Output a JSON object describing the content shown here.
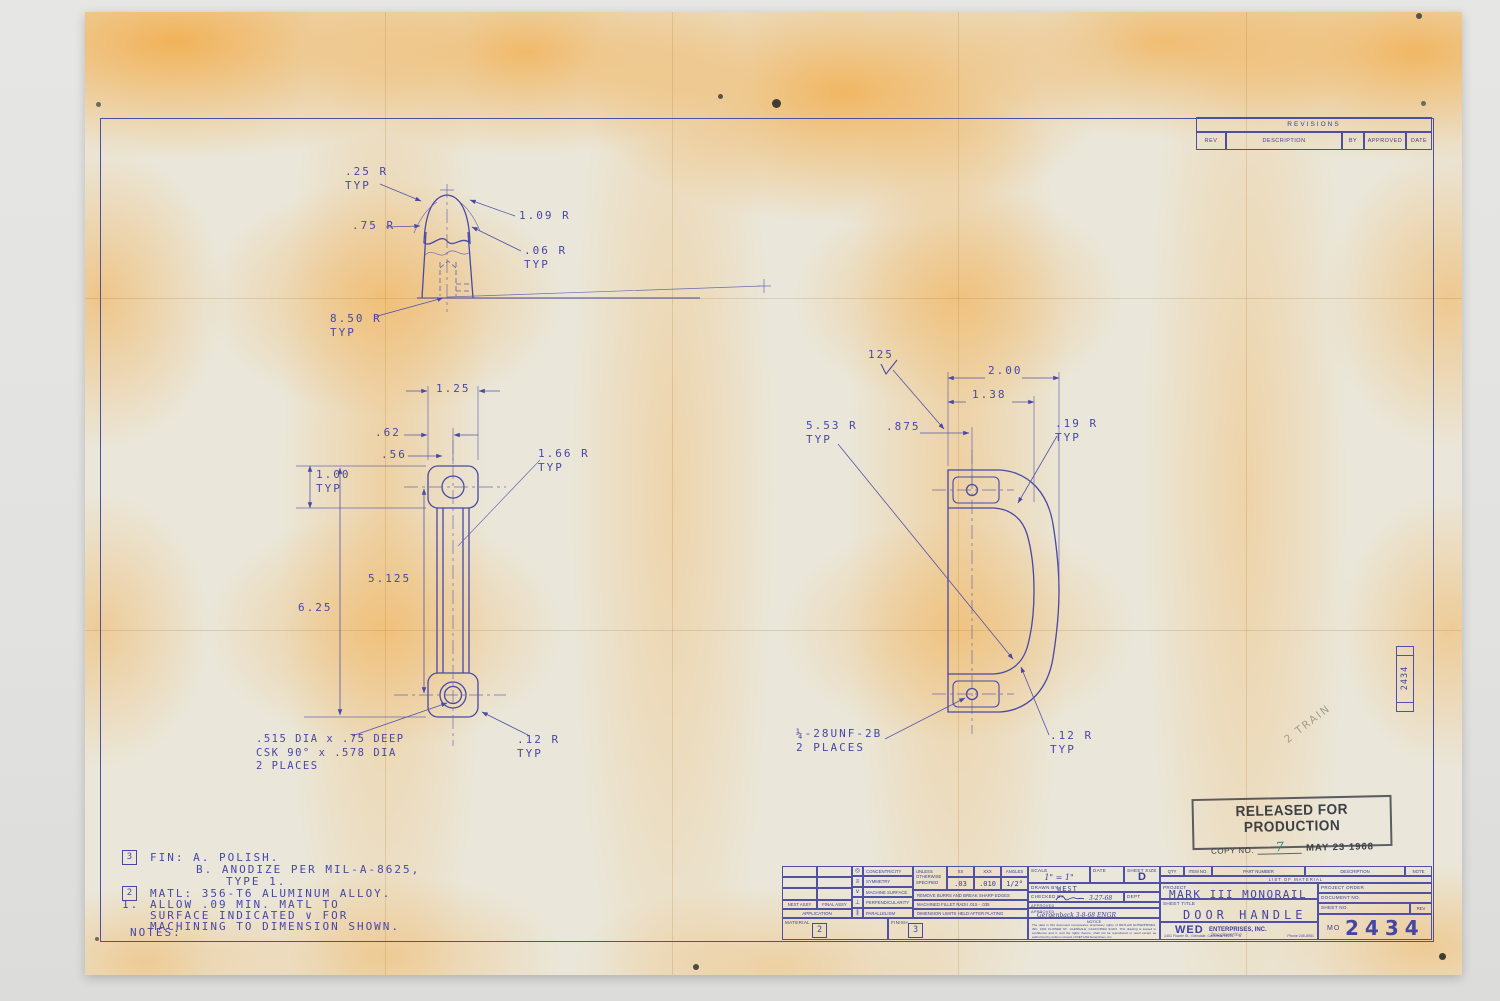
{
  "colors": {
    "ink": "#4848a6",
    "paper": "#eae7da",
    "aging": "#f2ae4e",
    "stamp": "#3e4046",
    "copy_teal": "#1e8e84",
    "pencil": "#a39d90"
  },
  "revisions": {
    "title": "REVISIONS",
    "col_rev": "REV",
    "col_description": "DESCRIPTION",
    "col_by": "BY",
    "col_approved": "APPROVED",
    "col_date": "DATE"
  },
  "section_view": {
    "r_25": ".25 R\nTYP",
    "r_75": ".75 R",
    "r_109": "1.09 R",
    "r_06": ".06 R\nTYP",
    "r_850": "8.50 R\nTYP"
  },
  "front_view": {
    "d_125": "1.25",
    "d_62": ".62",
    "d_56": ".56",
    "d_100": "1.00\nTYP",
    "r_166": "1.66 R\nTYP",
    "d_5125": "5.125",
    "d_625": "6.25",
    "hole_callout": ".515 DIA x .75 DEEP\nCSK 90° x .578 DIA\n2 PLACES",
    "r_12": ".12 R\nTYP"
  },
  "side_view": {
    "finish": "125",
    "d_200": "2.00",
    "d_138": "1.38",
    "d_875": ".875",
    "r_553": "5.53 R\nTYP",
    "r_19": ".19 R\nTYP",
    "thread": "¼-28UNF-2B\n2 PLACES",
    "r_12": ".12 R\nTYP"
  },
  "stamp": {
    "title": "RELEASED FOR PRODUCTION",
    "copy_label": "COPY NO.",
    "copy_value": "7",
    "date": "MAY 23 1968"
  },
  "pencil_note": "2 TRAIN",
  "edge_label": "2434",
  "notes": {
    "flag3": "3",
    "line1": "FIN: A. POLISH.",
    "line2": "B. ANODIZE PER MIL-A-8625,",
    "line3": "TYPE 1.",
    "flag2": "2",
    "line4": "MATL: 356-T6 ALUMINUM ALLOY.",
    "num1": "1.",
    "line5": "ALLOW .09 MIN. MATL TO",
    "line6": "SURFACE INDICATED ∨ FOR",
    "line7": "MACHINING TO DIMENSION SHOWN.",
    "header": "NOTES:"
  },
  "titleblock": {
    "next_assy": "NEXT ASSY",
    "final_assy": "FINAL ASSY",
    "application": "APPLICATION",
    "symbols": [
      {
        "sym": "◎",
        "label": "CONCENTRICITY"
      },
      {
        "sym": "≡",
        "label": "SYMMETRY"
      },
      {
        "sym": "∨",
        "label": "MACHINE SURFACE"
      },
      {
        "sym": "⊥",
        "label": "PERPENDICULARITY"
      },
      {
        "sym": "∥",
        "label": "PARALLELISM"
      }
    ],
    "tolerances": {
      "header": "UNLESS OTHERWISE SPECIFIED",
      "col1": "XX",
      "col2": "XXX",
      "col3": "ANGLES",
      "val1": ".03",
      "val2": ".010",
      "val3": "1/2°",
      "row1": "REMOVE BURRS AND BREAK SHARP EDGES",
      "row2": "MACHINED FILLET RADII .015 - .035",
      "row3": "DIMENSION LIMITS HELD AFTER PLATING"
    },
    "material_label": "MATERIAL",
    "material_flag": "2",
    "finish_label": "FINISH",
    "finish_flag": "3",
    "notice_title": "NOTICE",
    "notice_body": "The data in this document incorporates proprietary rights of RETLAW ENTERPRISES, INC.  1401 FLOWER ST., GLENDALE, CALIFORNIA 91201. This drawing is loaned in confidence and it, and the rights thereto, shall not be reproduced or used except as authorized by written consent of RETLAW Enterprises, Inc.",
    "scale_label": "SCALE",
    "scale_value": "1\" = 1\"",
    "date_label": "DATE",
    "sheet_size_label": "SHEET SIZE",
    "sheet_size_value": "D",
    "drawn_label": "DRAWN BY",
    "drawn_value": "WEST",
    "checked_label": "CHECKED BY",
    "checked_date": "3-27-68",
    "dept_label": "DEPT",
    "approved_label": "APPROVED",
    "approved2_label": "APPROVED",
    "approved_sig": "Gergenback  3-8-68  ENGR",
    "qty_label": "QTY",
    "item_no_label": "ITEM NO.",
    "part_number_label": "PART NUMBER",
    "description_label": "DESCRIPTION",
    "note_label": "NOTE",
    "lom_title": "LIST  OF  MATERIAL",
    "project_label": "PROJECT",
    "project_value": "MARK III MONORAIL",
    "sheet_title_label": "SHEET TITLE",
    "sheet_title_value": "DOOR HANDLE",
    "project_order_label": "PROJECT ORDER",
    "document_no_label": "DOCUMENT NO.",
    "sheet_no_label": "SHEET NO.",
    "rev_label": "REV",
    "company_wed": "WED",
    "company_name": "ENTERPRISES, INC.",
    "company_script": "Imagineering",
    "company_address": "1401 Flower St., Glendale, California 91201",
    "company_phone": "Phone 245-8951",
    "doc_prefix": "MO",
    "doc_number": "2434"
  }
}
